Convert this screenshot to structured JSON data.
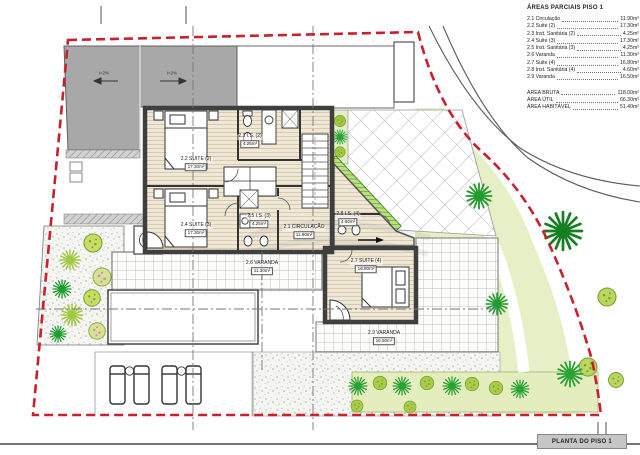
{
  "legend": {
    "title": "ÁREAS PARCIAIS PISO 1",
    "items": [
      {
        "label": "2.1 Circulação",
        "value": "11.90m²"
      },
      {
        "label": "2.2 Suite (2)",
        "value": "17.30m²"
      },
      {
        "label": "2.3 Inst. Sanitária (2)",
        "value": "4.25m²"
      },
      {
        "label": "2.4 Suite (3)",
        "value": "17.30m²"
      },
      {
        "label": "2.5 Inst. Sanitária (3)",
        "value": "4.25m²"
      },
      {
        "label": "2.6 Varanda",
        "value": "11.30m²"
      },
      {
        "label": "2.7 Suite (4)",
        "value": "16.80m²"
      },
      {
        "label": "2.8 Inst. Sanitária (4)",
        "value": "4.60m²"
      },
      {
        "label": "2.9 Varanda",
        "value": "16.50m²"
      }
    ],
    "totals": [
      {
        "label": "ÁREA BRUTA",
        "value": "118.00m²"
      },
      {
        "label": "ÁREA ÚTIL",
        "value": "66.30m²"
      },
      {
        "label": "ÁREA HABITÁVEL",
        "value": "51.40m²"
      }
    ]
  },
  "rooms": [
    {
      "name": "2.1 CIRCULAÇÃO",
      "area": "11.90m²"
    },
    {
      "name": "2.2 SUITE (2)",
      "area": "17.30m²"
    },
    {
      "name": "2.3 I.S. (2)",
      "area": "4.25m²"
    },
    {
      "name": "2.4 SUITE (3)",
      "area": "17.30m²"
    },
    {
      "name": "2.5 I.S. (3)",
      "area": "4.25m²"
    },
    {
      "name": "2.6 VARANDA",
      "area": "11.30m²"
    },
    {
      "name": "2.7 SUITE (4)",
      "area": "16.80m²"
    },
    {
      "name": "2.8 I.S. (4)",
      "area": "4.60m²"
    },
    {
      "name": "2.9 VARANDA",
      "area": "16.50m²"
    }
  ],
  "roof": {
    "left_slope": "i=2%",
    "right_slope": "i=2%"
  },
  "title_block": {
    "label": "PLANTA DO PISO 1"
  },
  "colors": {
    "boundary_red": "#c9202e",
    "roof_gray": "#a8a8a8",
    "lawn_green": "#e7efc6",
    "tree_dark": "#1f9c2c",
    "tree_light": "#b9d65e",
    "floor_beige": "#efe8d7"
  }
}
